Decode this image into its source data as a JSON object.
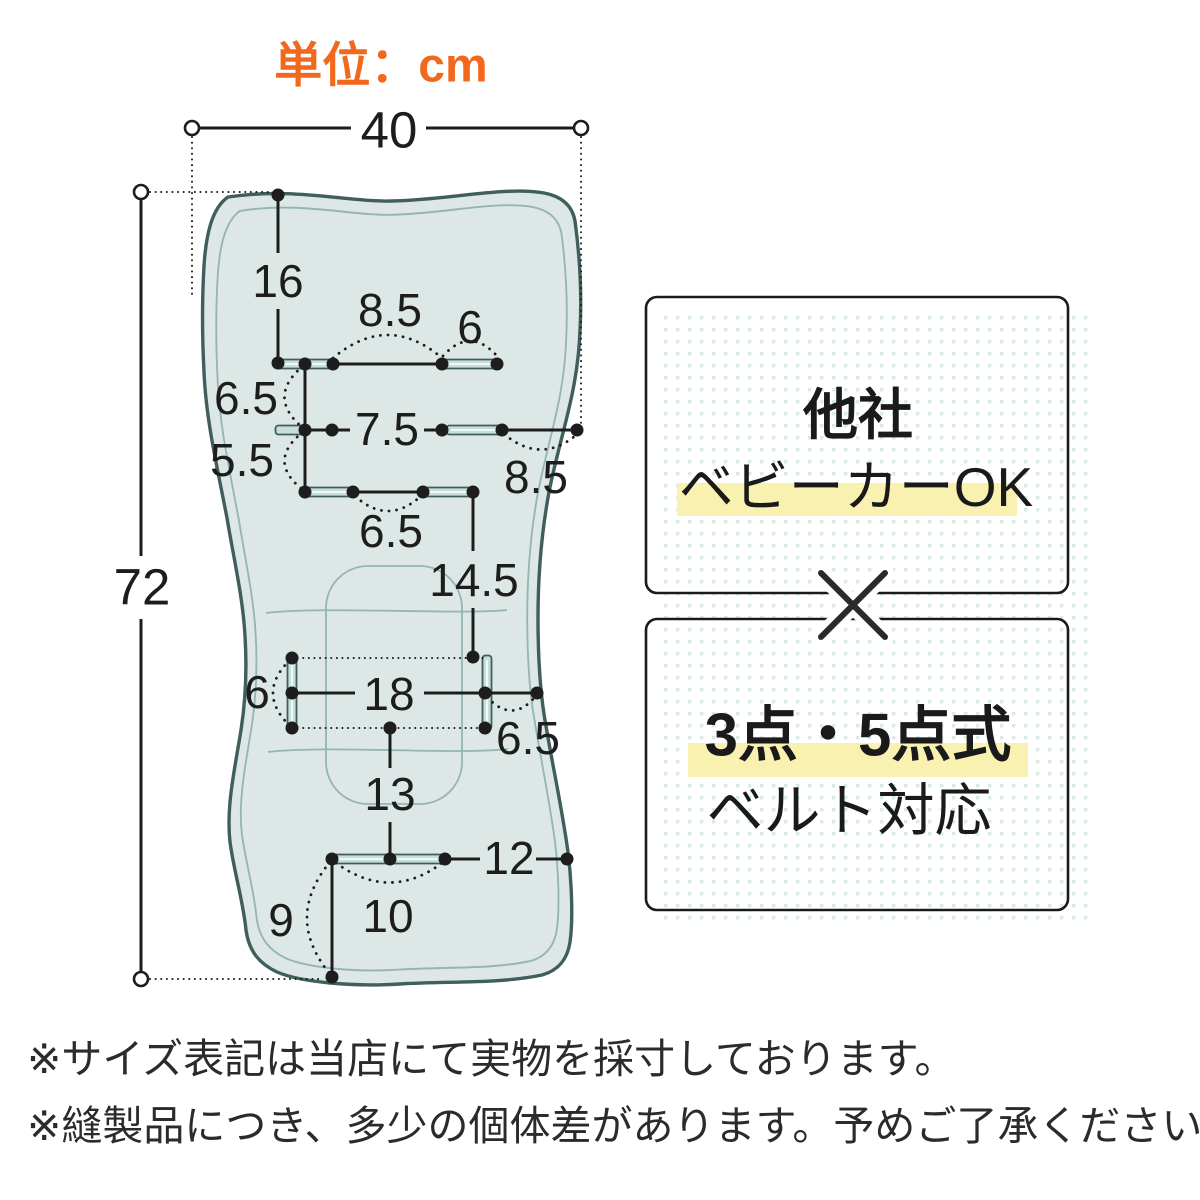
{
  "unit_label": "単位：cm",
  "colors": {
    "ink": "#1d1d1d",
    "accent_orange": "#f2691d",
    "pad_fill": "#dde8e6",
    "pad_outline": "#3f5e5c",
    "pad_inner": "#95b5b2",
    "slot_fill": "#c6dfdc",
    "slot_mid": "#f2f7f6",
    "highlight_yellow": "#f8f1b0",
    "pattern_dot": "#d8ebe7",
    "panel_border": "#1a1a1a",
    "text_dark": "#2b2b2b"
  },
  "dimensions": {
    "overall_width": "40",
    "overall_height": "72",
    "head_top_to_slot": "16",
    "shoulder_gap": "8.5",
    "shoulder_slot": "6",
    "row1_to_row2": "6.5",
    "row2_to_row3": "5.5",
    "row2_gap": "7.5",
    "row2_to_edge": "8.5",
    "row3_gap": "6.5",
    "row3_to_waist": "14.5",
    "waist_slot": "6",
    "waist_span": "18",
    "waist_to_edge": "6.5",
    "waist_to_bottom": "13",
    "bottom_to_edge": "12",
    "bottom_slot": "10",
    "bottom_to_hem": "9"
  },
  "callouts": {
    "box1_title": "他社",
    "box1_highlight": "ベビーカーOK",
    "box2_highlight": "3点・5点式",
    "box2_subtitle": "ベルト対応"
  },
  "footnotes": [
    "※サイズ表記は当店にて実物を採寸しております。",
    "※縫製品につき、多少の個体差があります。予めご了承ください。"
  ]
}
